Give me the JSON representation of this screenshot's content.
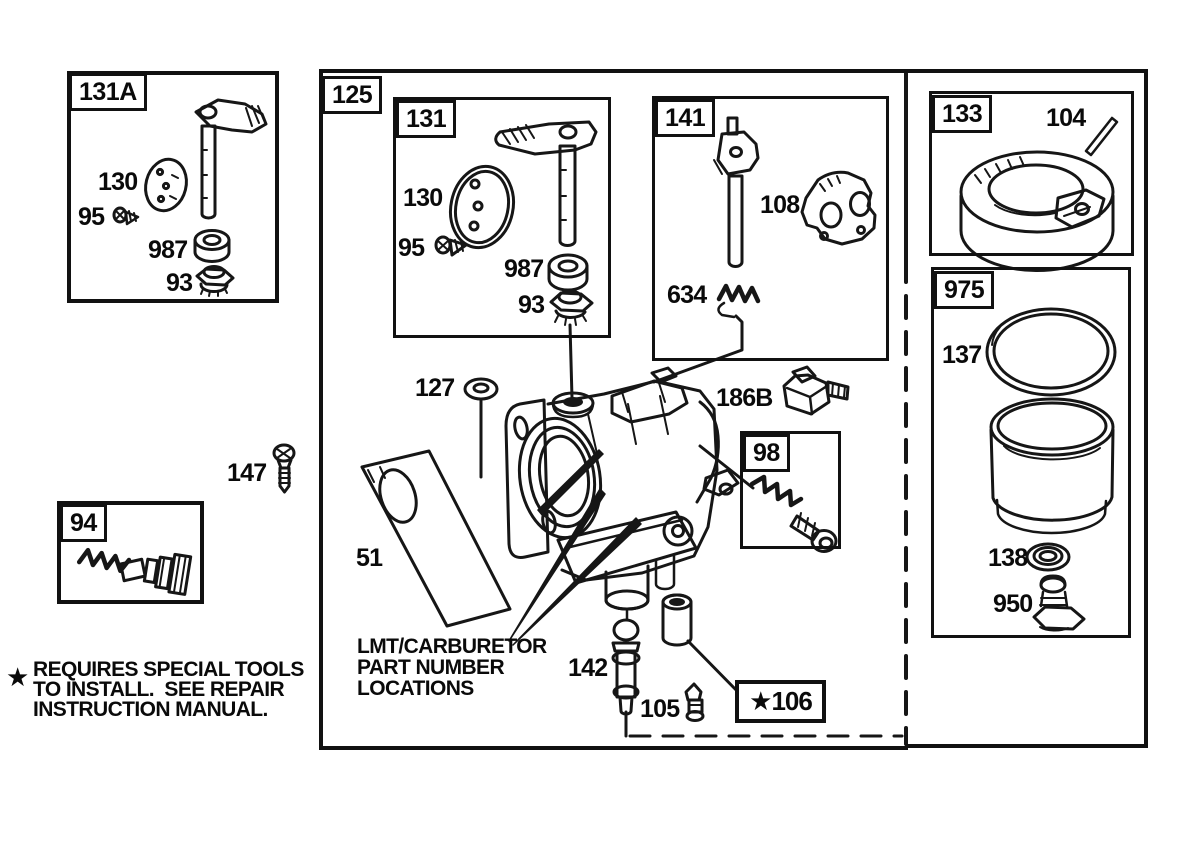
{
  "boxes": {
    "b131a": "131A",
    "b125": "125",
    "b131": "131",
    "b141": "141",
    "b98": "98",
    "b94": "94",
    "b133": "133",
    "b975": "975",
    "b106_starred": "★106"
  },
  "parts": {
    "a130": "130",
    "a95": "95",
    "a987": "987",
    "a93": "93",
    "m130": "130",
    "m95": "95",
    "m987": "987",
    "m93": "93",
    "p108": "108",
    "p634": "634",
    "p127": "127",
    "p147": "147",
    "p51": "51",
    "p186b": "186B",
    "p142": "142",
    "p105": "105",
    "p104": "104",
    "p137": "137",
    "p138": "138",
    "p950": "950"
  },
  "caption": {
    "lines": [
      "LMT/CARBURETOR",
      "PART NUMBER",
      "LOCATIONS"
    ]
  },
  "footnote": {
    "star": "★",
    "lines": [
      "REQUIRES SPECIAL TOOLS",
      "TO INSTALL.  SEE REPAIR",
      "INSTRUCTION MANUAL."
    ]
  }
}
